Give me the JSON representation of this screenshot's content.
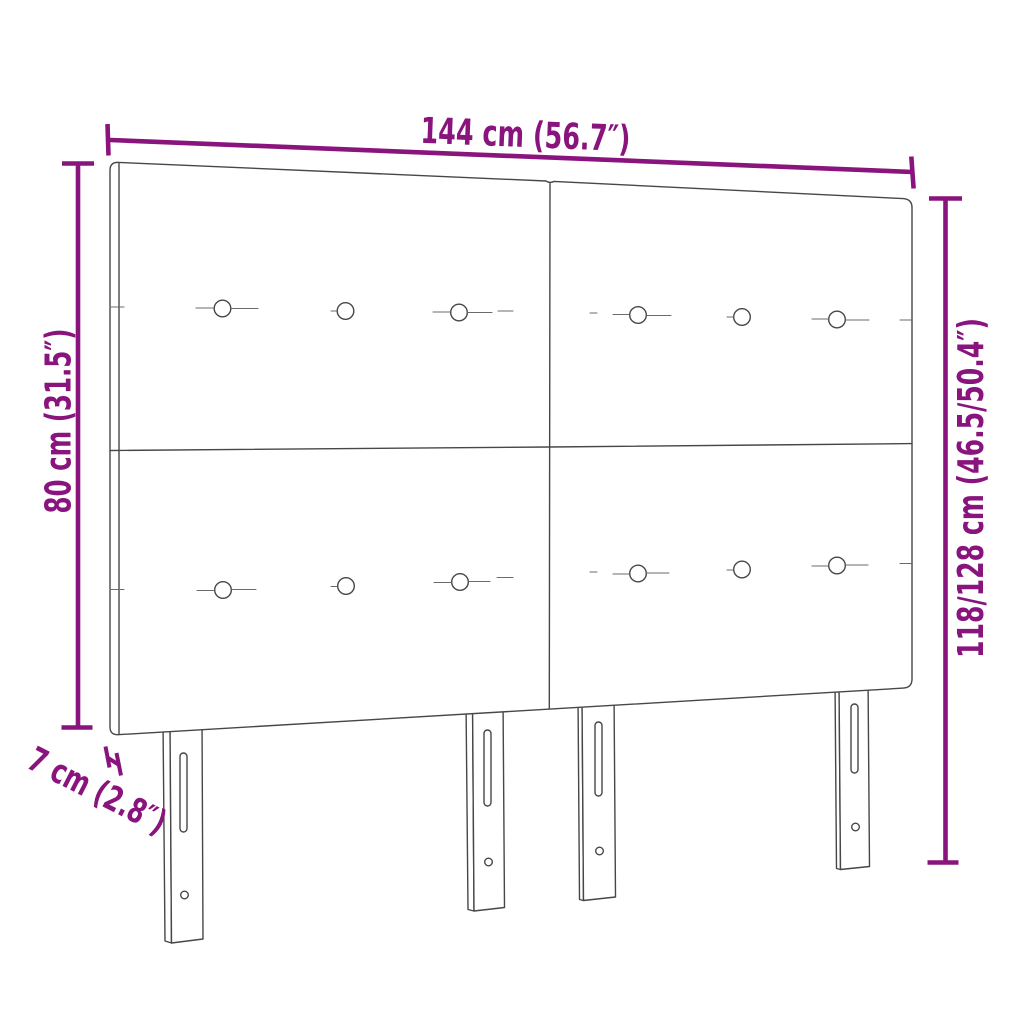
{
  "diagram": {
    "type": "product-dimension-diagram",
    "subject": "upholstered-headboard-four-panels-four-legs",
    "colors": {
      "dimension": "#8a147d",
      "outline": "#474747",
      "background": "#ffffff"
    },
    "labels": {
      "width": "144 cm (56.7″)",
      "panel_height": "80 cm (31.5″)",
      "total_height": "118/128 cm (46.5/50.4″)",
      "thickness": "7 cm (2.8″)"
    }
  }
}
